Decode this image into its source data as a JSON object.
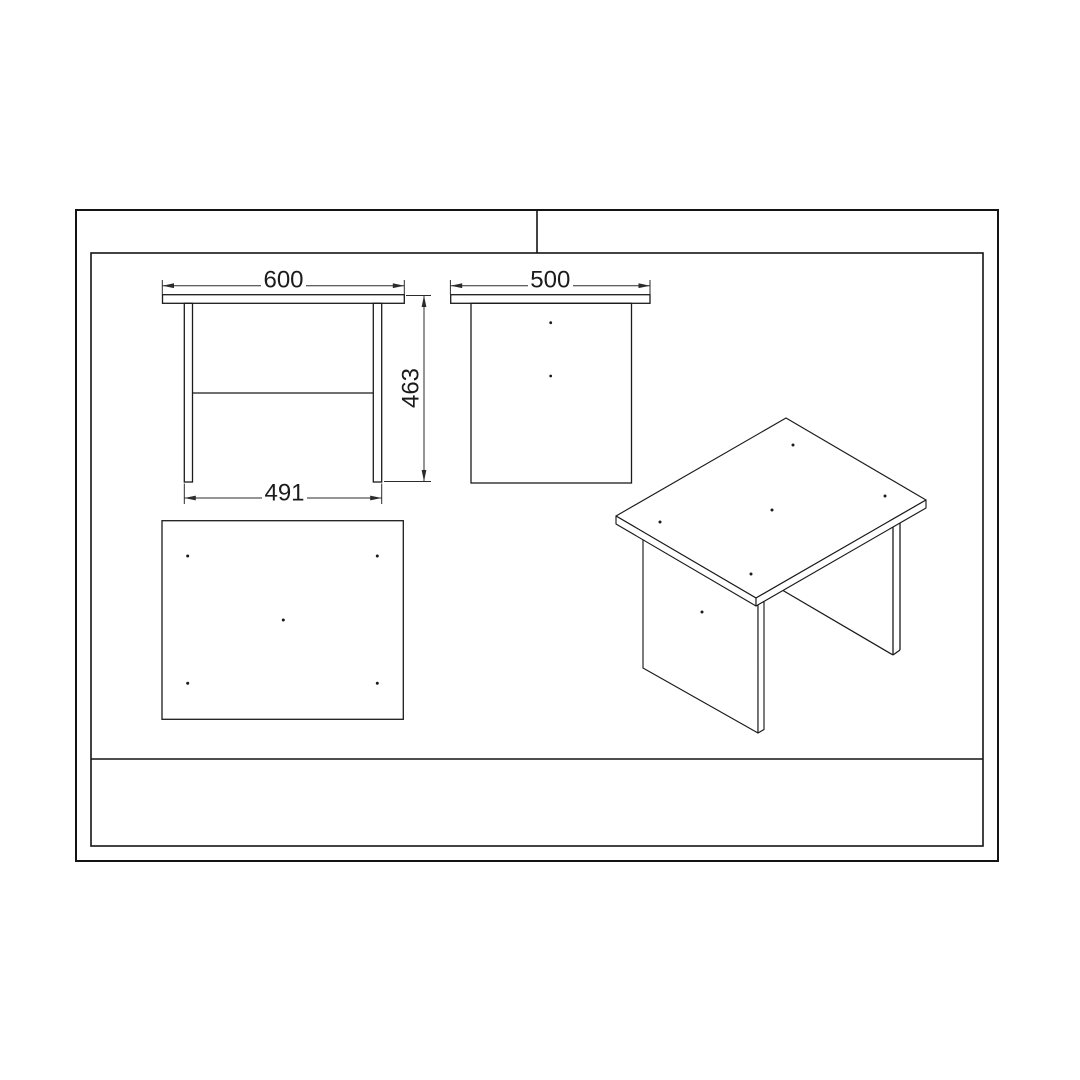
{
  "sheet": {
    "background": "#ffffff",
    "line_color": "#1b1b1b"
  },
  "dimensions": {
    "top_width": "600",
    "top_depth": "500",
    "height": "463",
    "leg_span": "491"
  }
}
